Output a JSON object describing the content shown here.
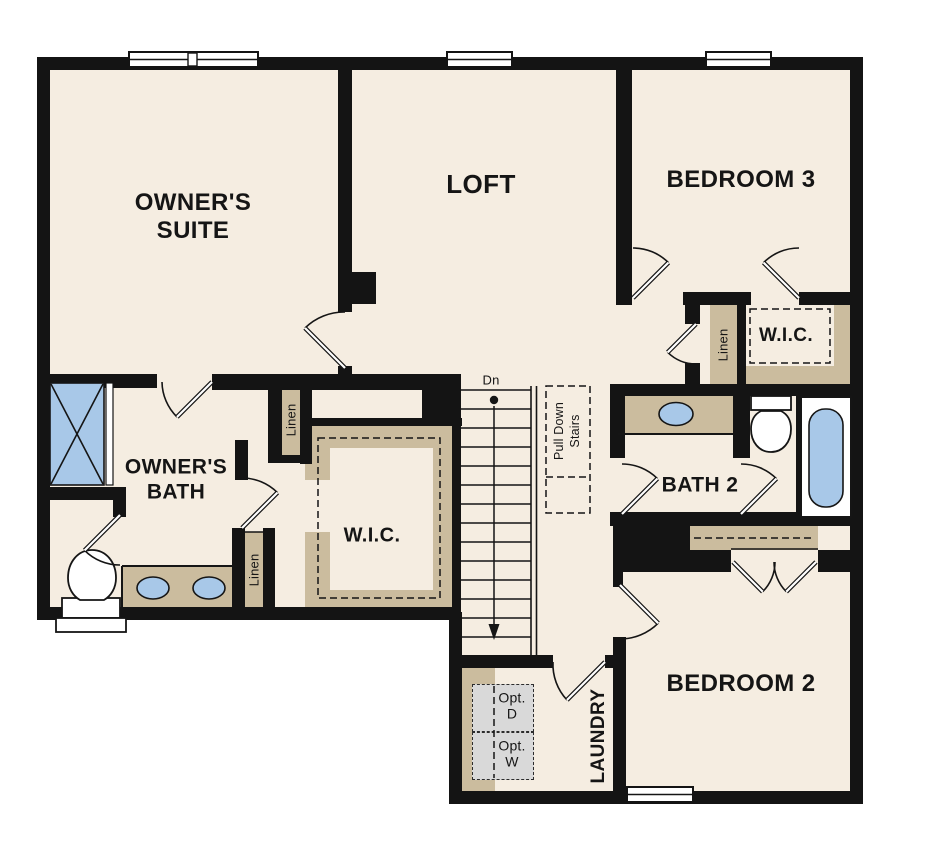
{
  "palette": {
    "wall": "#141414",
    "floor": "#f5ede1",
    "shelf_tan": "#cbbc9e",
    "fixture_blue": "#a8c8e8",
    "appliance_gray": "#d9d9d9",
    "paper": "#ffffff",
    "ink": "#151515"
  },
  "rooms": {
    "owners_suite": {
      "label": "OWNER'S SUITE"
    },
    "loft": {
      "label": "LOFT"
    },
    "bedroom3": {
      "label": "BEDROOM 3"
    },
    "owners_bath": {
      "label": "OWNER'S BATH"
    },
    "owners_wic": {
      "label": "W.I.C."
    },
    "bedroom3_wic": {
      "label": "W.I.C."
    },
    "bath2": {
      "label": "BATH 2"
    },
    "bedroom2": {
      "label": "BEDROOM 2"
    },
    "laundry": {
      "label": "LAUNDRY"
    }
  },
  "closets": {
    "linen_bath_upper": {
      "label": "Linen"
    },
    "linen_bath_lower": {
      "label": "Linen"
    },
    "linen_hall": {
      "label": "Linen"
    }
  },
  "stairs": {
    "direction_label": "Dn",
    "attic_access_label": "Pull Down Stairs"
  },
  "laundry_options": {
    "dryer": {
      "label": "Opt. D"
    },
    "washer": {
      "label": "Opt. W"
    }
  }
}
